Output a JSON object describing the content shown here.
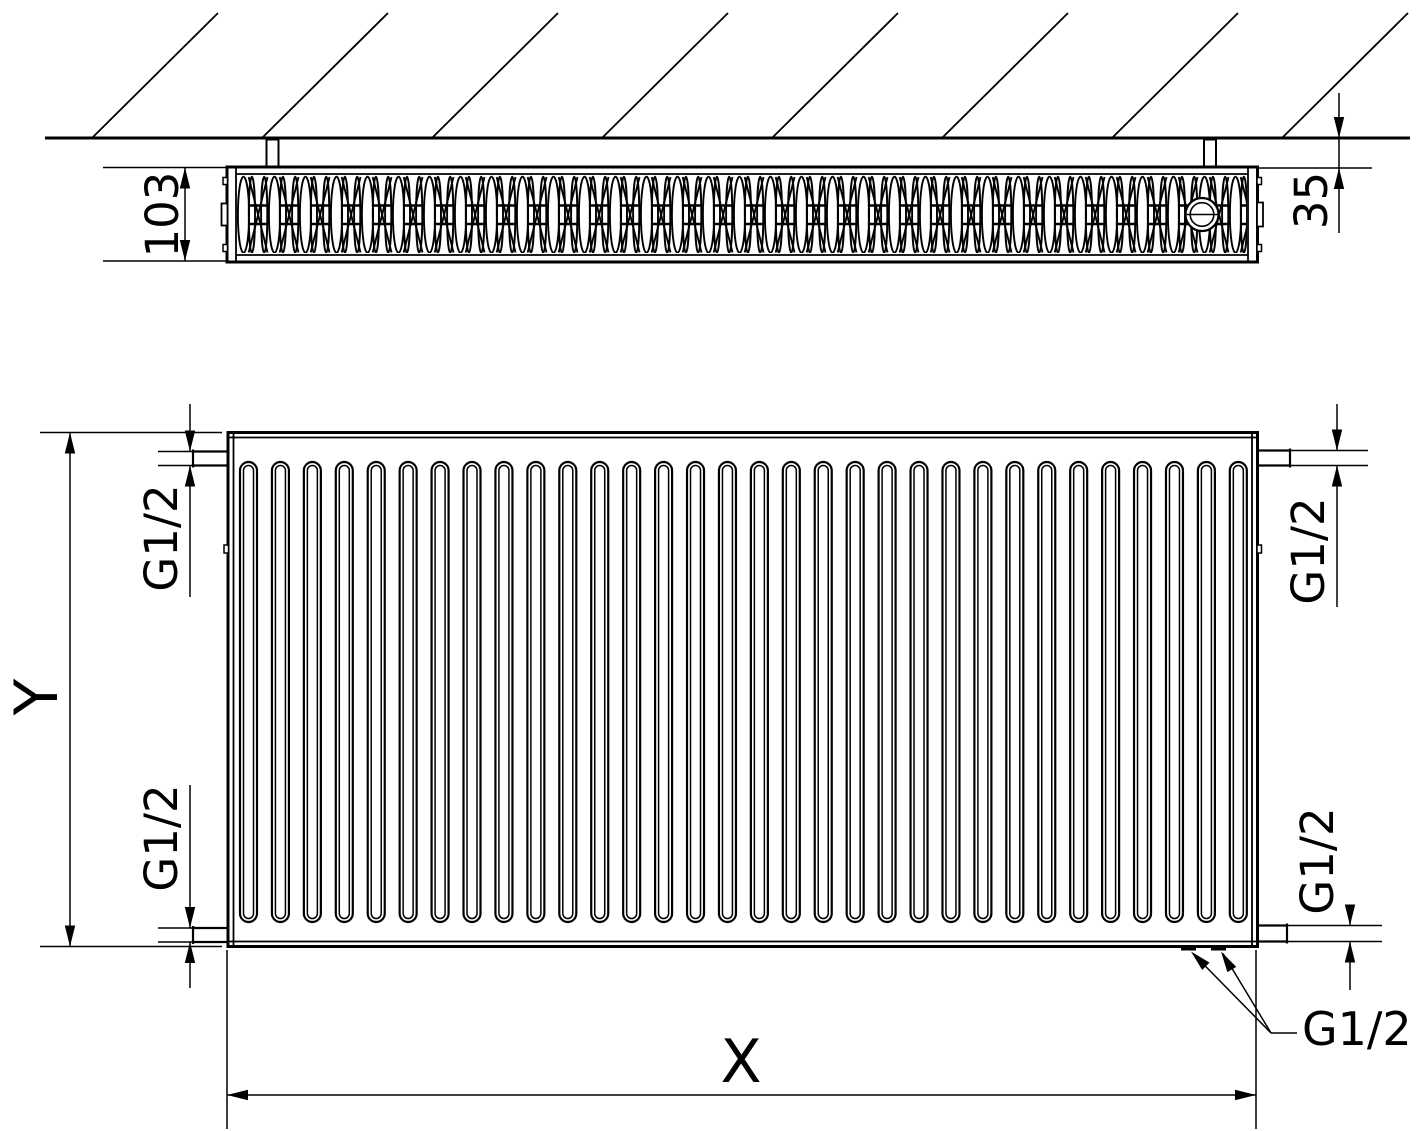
{
  "colors": {
    "line_color": "#000000",
    "background_color": "#ffffff",
    "text_color": "#000000"
  },
  "labels": {
    "top_view": {
      "depth": "103",
      "wall_distance": "35"
    },
    "front_view": {
      "height": "Y",
      "width": "X"
    },
    "connections": {
      "top_left": "G1/2",
      "bottom_left": "G1/2",
      "top_right": "G1/2",
      "bottom_right": "G1/2",
      "bottom_callout": "G1/2"
    }
  }
}
